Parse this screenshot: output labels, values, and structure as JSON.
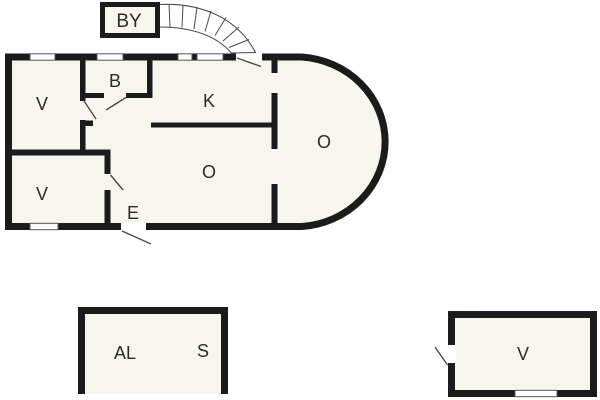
{
  "document": {
    "type": "floor-plan"
  },
  "labels": {
    "by": "BY",
    "upper_v": "V",
    "b": "B",
    "k": "K",
    "o_center": "O",
    "o_right": "O",
    "e": "E",
    "lower_v": "V",
    "al": "AL",
    "s": "S",
    "outbuilding_v": "V"
  },
  "colors": {
    "background": "#ffffff",
    "wall": "#1b1b1b",
    "floor_fill": "#f6f5ee",
    "thin_line": "#4a4a4a",
    "label_text": "#2b2b2b"
  }
}
